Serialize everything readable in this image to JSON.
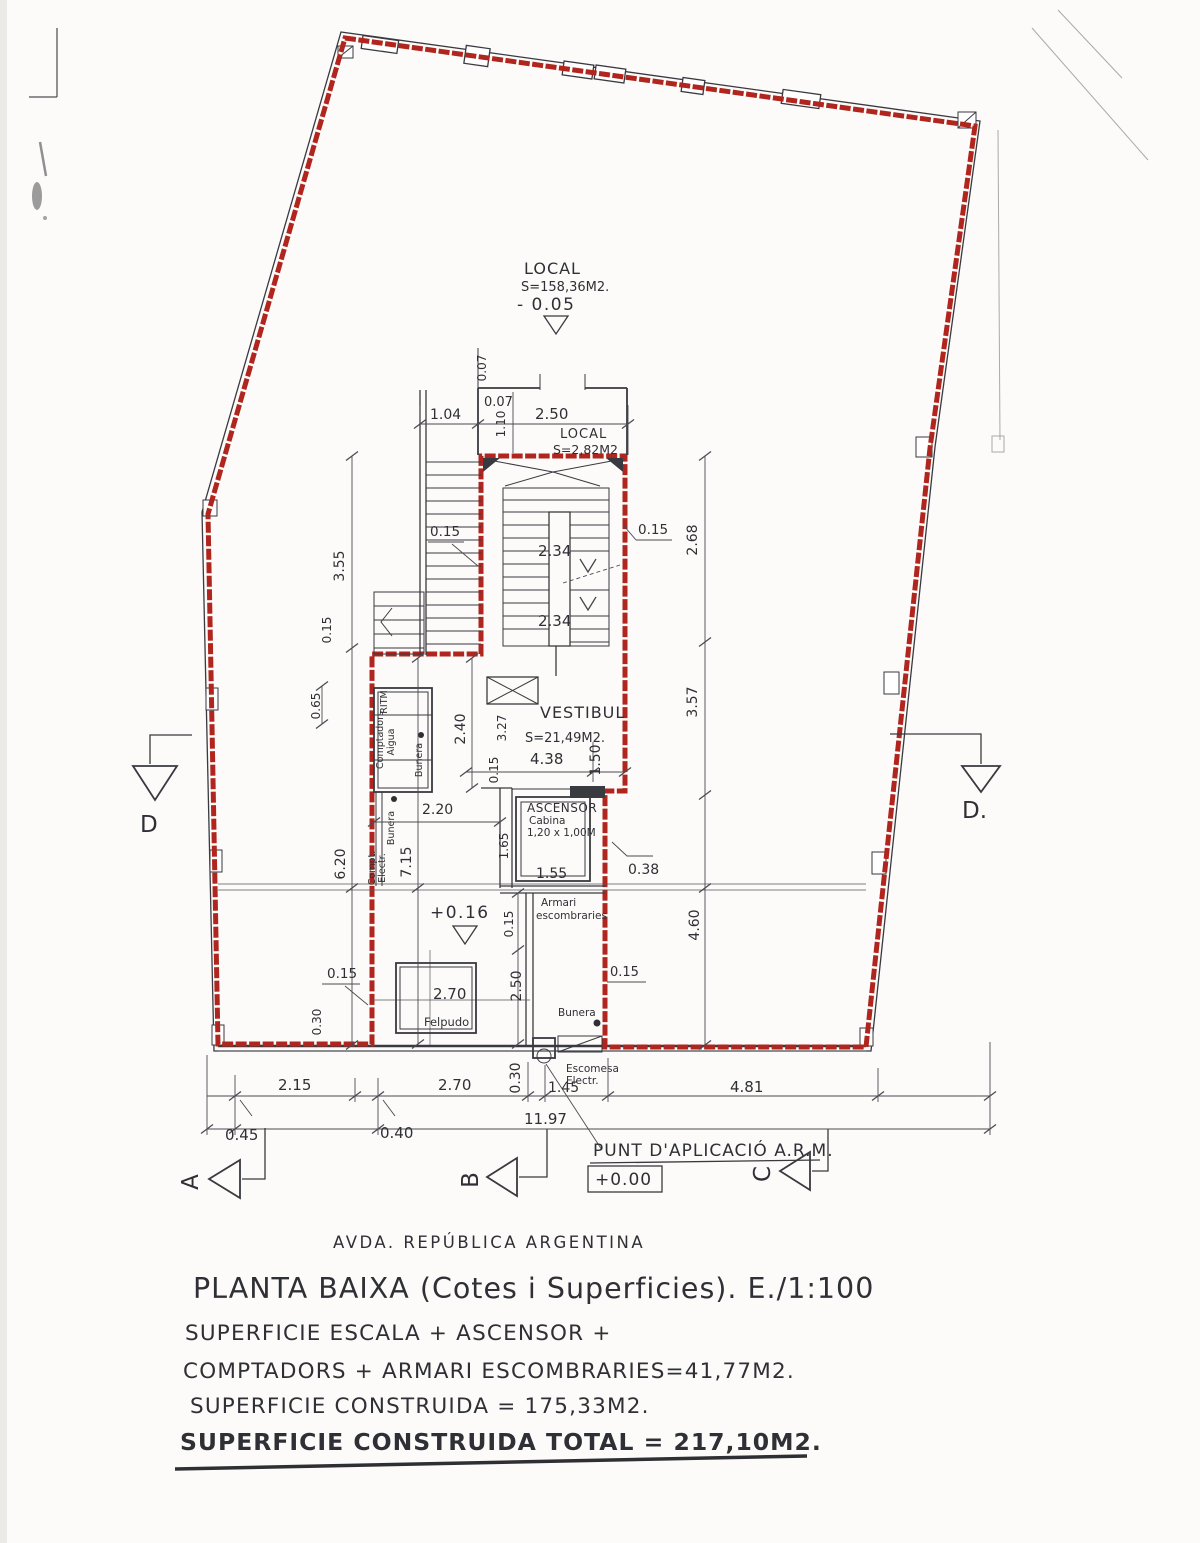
{
  "colors": {
    "outline_red": "#b0251d",
    "ink": "#393a40"
  },
  "rooms": {
    "local_main": {
      "name": "LOCAL",
      "area": "S=158,36M2.",
      "level": "- 0.05"
    },
    "local_small": {
      "name": "LOCAL",
      "area": "S=2,82M2"
    },
    "vestibule": {
      "name": "VESTIBUL",
      "area": "S=21,49M2."
    },
    "elevator": {
      "name": "ASCENSOR",
      "line2": "Cabina",
      "line3": "1,20 x 1,00M"
    },
    "trash": {
      "line1": "Armari",
      "line2": "escombraries"
    },
    "doormat": "Felpudo",
    "ritm": "RITM",
    "water_meters": {
      "line1": "Comptadors",
      "line2": "Aigua"
    },
    "electric_meter": {
      "line1": "Compt.",
      "line2": "Electr.",
      "line3": "Bunera"
    },
    "drain_a": "Bunera",
    "drain_b": "Bunera",
    "service_entry": {
      "line1": "Escomesa",
      "line2": "Electr."
    },
    "entry_level": "+0.16",
    "arm_point": {
      "label": "PUNT D'APLICACIÓ A.R.M.",
      "level": "+0.00"
    }
  },
  "dims": {
    "v007": "0.07",
    "h007": "0.07",
    "w104": "1.04",
    "v110": "1.10",
    "w250": "2.50",
    "v268": "2.68",
    "s015l": "0.15",
    "s015r": "0.15",
    "w234a": "2.34",
    "w234b": "2.34",
    "v355": "3.55",
    "v015a": "0.15",
    "v065": "0.65",
    "v357": "3.57",
    "v240": "2.40",
    "v327": "3.27",
    "w438": "4.38",
    "v150": "1.50",
    "v015b": "0.15",
    "w220": "2.20",
    "v715": "7.15",
    "v620": "6.20",
    "v165": "1.65",
    "w155": "1.55",
    "w038": "0.38",
    "v015c": "0.15",
    "v460": "4.60",
    "h015a": "0.15",
    "v030a": "0.30",
    "w270fel": "2.70",
    "v250": "2.50",
    "h015b": "0.15",
    "b215": "2.15",
    "b270": "2.70",
    "b030": "0.30",
    "b145": "1.45",
    "b481": "4.81",
    "b045": "0.45",
    "b040": "0.40",
    "b1197": "11.97"
  },
  "markers": {
    "a": "A",
    "b": "B",
    "c": "C",
    "d_left": "D",
    "d_right": "D."
  },
  "footer": {
    "street": "AVDA. REPÚBLICA ARGENTINA",
    "title": "PLANTA BAIXA (Cotes i Superficies). E./1:100",
    "line1": "SUPERFICIE ESCALA + ASCENSOR +",
    "line2": "COMPTADORS + ARMARI ESCOMBRARIES=41,77M2.",
    "line3": "SUPERFICIE CONSTRUIDA = 175,33M2.",
    "line4": "SUPERFICIE CONSTRUIDA TOTAL = 217,10M2."
  }
}
